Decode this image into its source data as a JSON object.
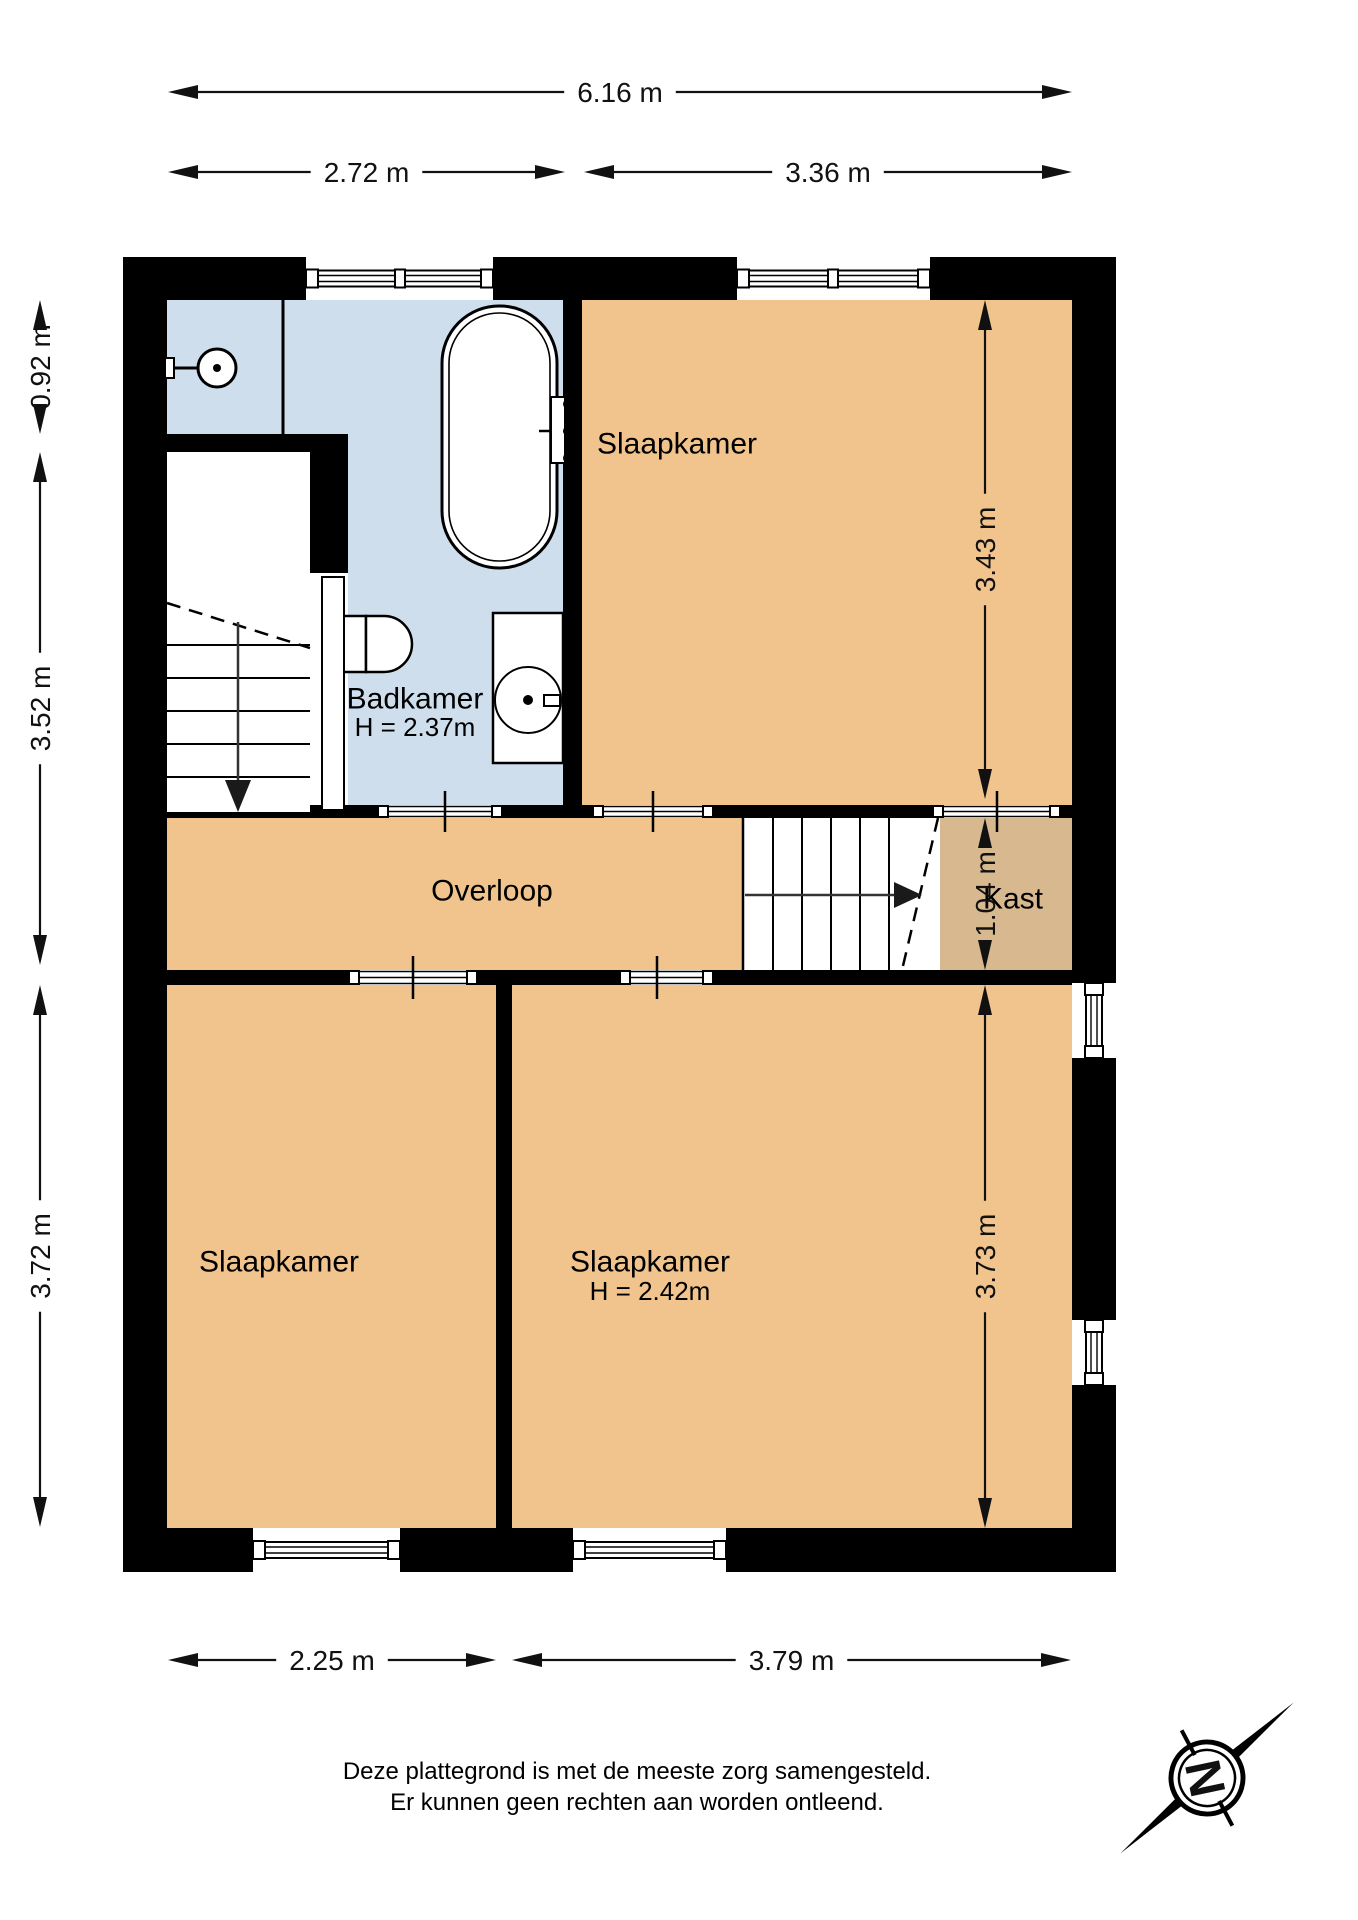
{
  "colors": {
    "wall": "#000000",
    "bathroom_floor": "#cfdeed",
    "room_floor": "#f0c48c",
    "closet_floor": "#d8b88e",
    "fixture_fill": "#ffffff",
    "line": "#000000",
    "dim_text": "#111111"
  },
  "rooms": [
    {
      "id": "badkamer",
      "fill": "bathroom_floor",
      "rect": [
        167,
        300,
        396,
        505
      ],
      "label": "Badkamer",
      "sublabel": "H = 2.37m",
      "label_xy": [
        415,
        699
      ],
      "sublabel_xy": [
        415,
        727
      ]
    },
    {
      "id": "slaapkamer-boven",
      "fill": "room_floor",
      "rect": [
        582,
        300,
        490,
        505
      ],
      "label": "Slaapkamer",
      "label_xy": [
        677,
        444
      ]
    },
    {
      "id": "overloop",
      "fill": "room_floor",
      "rect": [
        167,
        818,
        576,
        152
      ],
      "label": "Overloop",
      "label_xy": [
        492,
        891
      ]
    },
    {
      "id": "kast",
      "fill": "closet_floor",
      "poly": [
        [
          938,
          818
        ],
        [
          1072,
          818
        ],
        [
          1072,
          970
        ],
        [
          902,
          970
        ]
      ],
      "label": "Kast",
      "label_xy": [
        1013,
        899
      ]
    },
    {
      "id": "slaapkamer-linksonder",
      "fill": "room_floor",
      "rect": [
        167,
        985,
        329,
        543
      ],
      "label": "Slaapkamer",
      "label_xy": [
        279,
        1262
      ]
    },
    {
      "id": "slaapkamer-rechtsonder",
      "fill": "room_floor",
      "rect": [
        512,
        985,
        560,
        543
      ],
      "label": "Slaapkamer",
      "sublabel": "H = 2.42m",
      "label_xy": [
        650,
        1262
      ],
      "sublabel_xy": [
        650,
        1291
      ]
    }
  ],
  "walls": [
    {
      "id": "top-a",
      "r": [
        123,
        257,
        183,
        43
      ]
    },
    {
      "id": "top-b",
      "r": [
        493,
        257,
        244,
        43
      ]
    },
    {
      "id": "top-c",
      "r": [
        930,
        257,
        186,
        43
      ]
    },
    {
      "id": "left",
      "r": [
        123,
        257,
        44,
        1315
      ]
    },
    {
      "id": "right-a",
      "r": [
        1072,
        257,
        44,
        726
      ]
    },
    {
      "id": "right-b",
      "r": [
        1072,
        1058,
        44,
        262
      ]
    },
    {
      "id": "right-c",
      "r": [
        1072,
        1385,
        44,
        187
      ]
    },
    {
      "id": "bottom-a",
      "r": [
        123,
        1528,
        130,
        44
      ]
    },
    {
      "id": "bottom-b",
      "r": [
        400,
        1528,
        173,
        44
      ]
    },
    {
      "id": "bottom-c",
      "r": [
        726,
        1528,
        390,
        44
      ]
    },
    {
      "id": "douche-trap",
      "r": [
        167,
        434,
        181,
        18
      ]
    },
    {
      "id": "trap-badkamer",
      "r": [
        310,
        452,
        38,
        121
      ]
    },
    {
      "id": "badkamer-slaapkamer",
      "r": [
        563,
        300,
        19,
        505
      ]
    },
    {
      "id": "middenband-boven-1",
      "r": [
        310,
        805,
        68,
        13
      ]
    },
    {
      "id": "middenband-boven-2",
      "r": [
        502,
        805,
        91,
        13
      ]
    },
    {
      "id": "middenband-boven-3",
      "r": [
        713,
        805,
        220,
        13
      ]
    },
    {
      "id": "middenband-boven-4",
      "r": [
        1060,
        805,
        12,
        13
      ]
    },
    {
      "id": "trapgat-overloop",
      "r": [
        167,
        812,
        143,
        6
      ]
    },
    {
      "id": "middenband-onder-1",
      "r": [
        167,
        970,
        182,
        15
      ]
    },
    {
      "id": "middenband-onder-2",
      "r": [
        477,
        970,
        143,
        15
      ]
    },
    {
      "id": "middenband-onder-3",
      "r": [
        713,
        970,
        359,
        15
      ]
    },
    {
      "id": "slaapkamers-scheiding",
      "r": [
        496,
        985,
        16,
        543
      ]
    }
  ],
  "windows": [
    {
      "id": "window-top-badkamer",
      "orient": "h",
      "span": [
        306,
        493
      ],
      "wall": [
        257,
        300
      ],
      "divider": 400
    },
    {
      "id": "window-top-slaapkamer",
      "orient": "h",
      "span": [
        737,
        930
      ],
      "wall": [
        257,
        300
      ],
      "divider": 833
    },
    {
      "id": "window-right-1",
      "orient": "v",
      "span": [
        983,
        1058
      ],
      "wall": [
        1072,
        1116
      ]
    },
    {
      "id": "window-right-2",
      "orient": "v",
      "span": [
        1320,
        1385
      ],
      "wall": [
        1072,
        1116
      ]
    },
    {
      "id": "window-bottom-1",
      "orient": "h",
      "span": [
        253,
        400
      ],
      "wall": [
        1528,
        1572
      ]
    },
    {
      "id": "window-bottom-2",
      "orient": "h",
      "span": [
        573,
        726
      ],
      "wall": [
        1528,
        1572
      ]
    }
  ],
  "openings": [
    {
      "id": "deur-badkamer",
      "span": [
        378,
        502
      ],
      "wall": [
        805,
        818
      ],
      "tick": 445
    },
    {
      "id": "deur-slaapkamer-boven",
      "span": [
        593,
        713
      ],
      "wall": [
        805,
        818
      ],
      "tick": 653
    },
    {
      "id": "deur-kast",
      "span": [
        933,
        1060
      ],
      "wall": [
        805,
        818
      ],
      "tick": 997
    },
    {
      "id": "deur-slaapkamer-links",
      "span": [
        349,
        477
      ],
      "wall": [
        970,
        985
      ],
      "tick": 413
    },
    {
      "id": "deur-slaapkamer-rechts",
      "span": [
        620,
        713
      ],
      "wall": [
        970,
        985
      ],
      "tick": 657
    }
  ],
  "stairs_down": {
    "box": [
      167,
      452,
      143,
      358
    ],
    "tread_span": [
      167,
      310
    ],
    "treads": [
      645,
      678,
      711,
      744,
      777
    ],
    "diagonal": [
      [
        167,
        603
      ],
      [
        310,
        648
      ]
    ],
    "center_line": [
      [
        238,
        622
      ],
      [
        238,
        780
      ]
    ],
    "arrow": {
      "tip": [
        238,
        812
      ],
      "base_y": 780,
      "half": 13
    }
  },
  "stairs_up": {
    "box": [
      743,
      818,
      197,
      152
    ],
    "tread_span": [
      818,
      970
    ],
    "treads": [
      773,
      802,
      831,
      860,
      889
    ],
    "left_edge": [
      [
        743,
        818
      ],
      [
        743,
        970
      ]
    ],
    "diagonal": [
      [
        938,
        818
      ],
      [
        902,
        970
      ]
    ],
    "center_line": [
      [
        745,
        895
      ],
      [
        894,
        895
      ]
    ],
    "arrow": {
      "tip": [
        922,
        895
      ],
      "base_x": 894,
      "half": 13
    }
  },
  "fixtures": {
    "shower_screen": [
      [
        283,
        300
      ],
      [
        283,
        434
      ]
    ],
    "shower_plate": [
      165,
      358,
      9,
      20
    ],
    "shower_arm": [
      [
        174,
        368
      ],
      [
        199,
        368
      ]
    ],
    "shower_head": [
      217,
      368,
      19
    ],
    "shower_dot": [
      217,
      368,
      4
    ],
    "bath_outer": [
      442,
      306,
      115,
      262,
      57
    ],
    "bath_inner": [
      449,
      313,
      101,
      248,
      50
    ],
    "bath_faucet_bar": [
      551,
      397,
      14,
      66
    ],
    "bath_knobs": [
      [
        568,
        404
      ],
      [
        568,
        431
      ],
      [
        568,
        458
      ]
    ],
    "bath_spout": [
      [
        551,
        431
      ],
      [
        539,
        431
      ]
    ],
    "toilet_cistern": [
      340,
      616,
      26,
      56
    ],
    "toilet_bowl": "M366,616 h18 a28,28 0 0 1 28,28 a28,28 0 0 1 -28,28 h-18 z",
    "sink_rect": [
      493,
      613,
      70,
      150
    ],
    "sink_basin": [
      528,
      700,
      33
    ],
    "sink_dot": [
      528,
      700,
      5
    ],
    "sink_tap": [
      544,
      695,
      16,
      11
    ],
    "door_gap": [
      310,
      573,
      38,
      239
    ],
    "door_leaf": [
      322,
      577,
      22,
      233
    ]
  },
  "dimensions": [
    {
      "id": "dim-breedte-totaal",
      "orient": "h",
      "pos": 92,
      "span": [
        168,
        1072
      ],
      "label": "6.16 m"
    },
    {
      "id": "dim-breedte-badkamer",
      "orient": "h",
      "pos": 172,
      "span": [
        168,
        565
      ],
      "label": "2.72 m"
    },
    {
      "id": "dim-breedte-slaapkamer-boven",
      "orient": "h",
      "pos": 172,
      "span": [
        584,
        1072
      ],
      "label": "3.36 m"
    },
    {
      "id": "dim-hoogte-douche",
      "orient": "v",
      "pos": 40,
      "span": [
        300,
        434
      ],
      "label": "0.92 m"
    },
    {
      "id": "dim-hoogte-trap",
      "orient": "v",
      "pos": 40,
      "span": [
        452,
        965
      ],
      "label": "3.52 m"
    },
    {
      "id": "dim-hoogte-slaapkamer-links",
      "orient": "v",
      "pos": 40,
      "span": [
        985,
        1527
      ],
      "label": "3.72 m"
    },
    {
      "id": "dim-hoogte-slaapkamer-boven",
      "orient": "v",
      "pos": 985,
      "span": [
        300,
        799
      ],
      "label": "3.43 m"
    },
    {
      "id": "dim-hoogte-kast",
      "orient": "v",
      "pos": 985,
      "span": [
        818,
        970
      ],
      "label": "1.04 m"
    },
    {
      "id": "dim-hoogte-slaapkamer-rechts",
      "orient": "v",
      "pos": 985,
      "span": [
        985,
        1528
      ],
      "label": "3.73 m"
    },
    {
      "id": "dim-onder-links",
      "orient": "h",
      "pos": 1660,
      "span": [
        168,
        496
      ],
      "label": "2.25 m"
    },
    {
      "id": "dim-onder-rechts",
      "orient": "h",
      "pos": 1660,
      "span": [
        512,
        1071
      ],
      "label": "3.79 m"
    }
  ],
  "disclaimer": {
    "line1": "Deze plattegrond is met de meeste zorg samengesteld.",
    "line2": "Er kunnen geen rechten aan worden ontleend."
  },
  "compass": {
    "letter": "N",
    "cx": 1207,
    "cy": 1778,
    "needle_angle": -28,
    "letter_rotation": 78
  }
}
